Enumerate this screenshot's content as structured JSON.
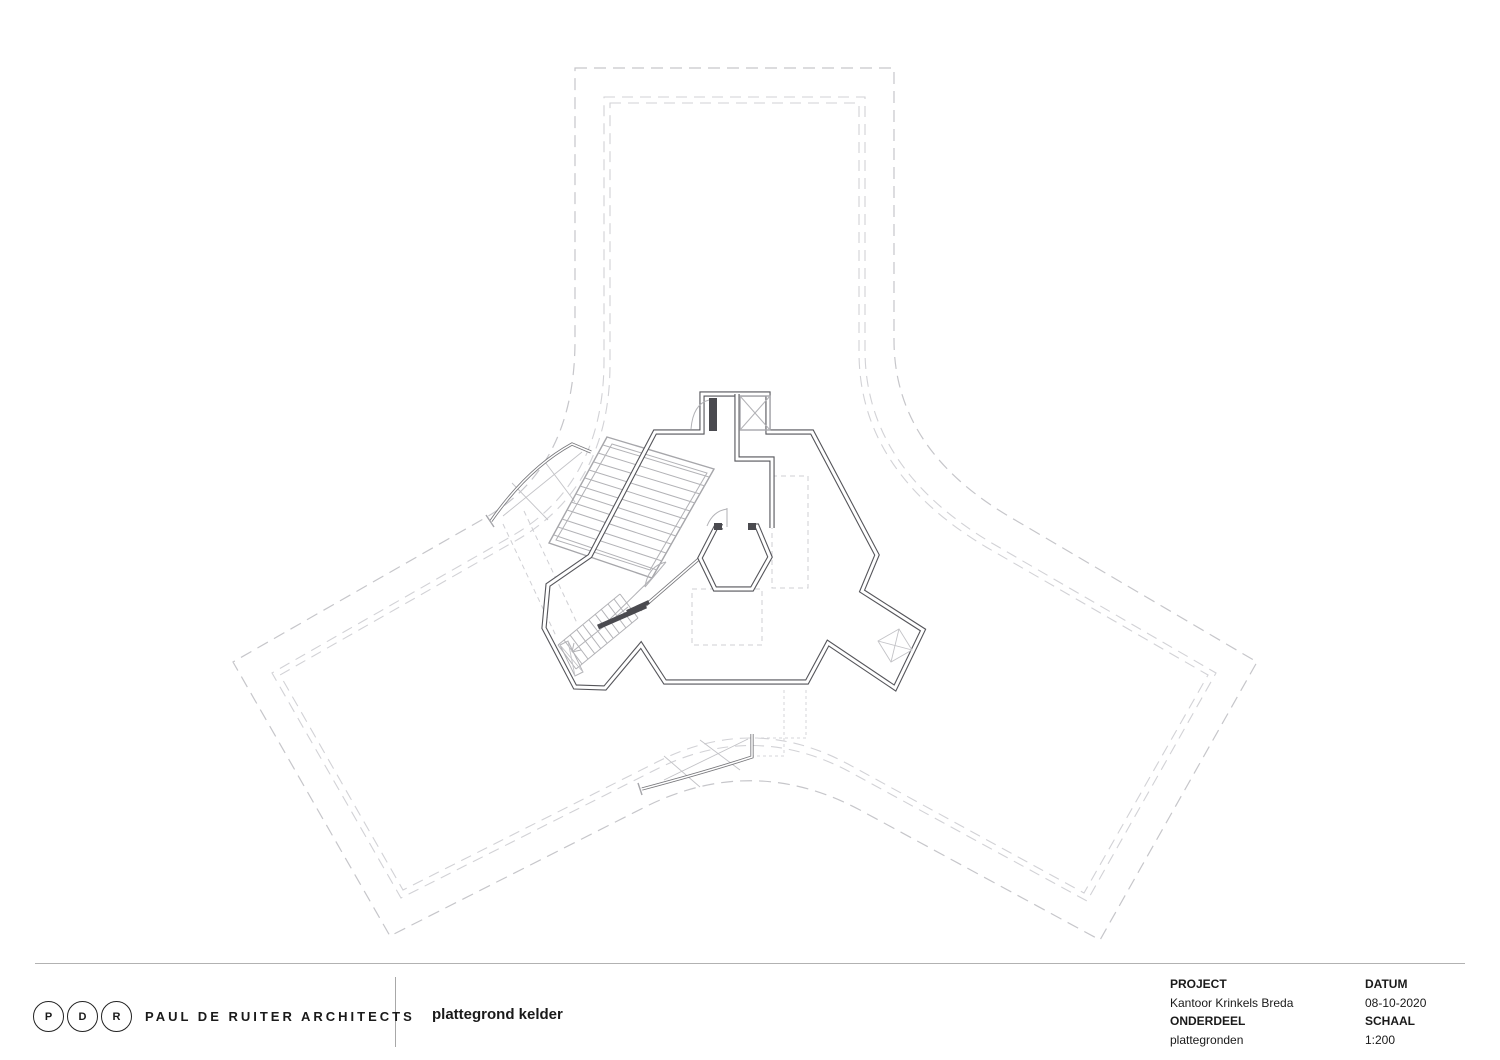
{
  "footer": {
    "logo": {
      "letters": [
        "P",
        "D",
        "R"
      ],
      "firm": "PAUL DE RUITER ARCHITECTS"
    },
    "drawing_title": "plattegrond kelder",
    "title_block": {
      "project_label": "PROJECT",
      "project_value": "Kantoor Krinkels Breda",
      "onderdeel_label": "ONDERDEEL",
      "onderdeel_value": "plattegronden",
      "datum_label": "DATUM",
      "datum_value": "08-10-2020",
      "schaal_label": "SCHAAL",
      "schaal_value": "1:200"
    }
  },
  "colors": {
    "wall": "#55555a",
    "dash-line": "#c6c6ca",
    "dash-line-light": "#d2d2d6",
    "paper": "#ffffff",
    "text": "#1a1a1a"
  }
}
